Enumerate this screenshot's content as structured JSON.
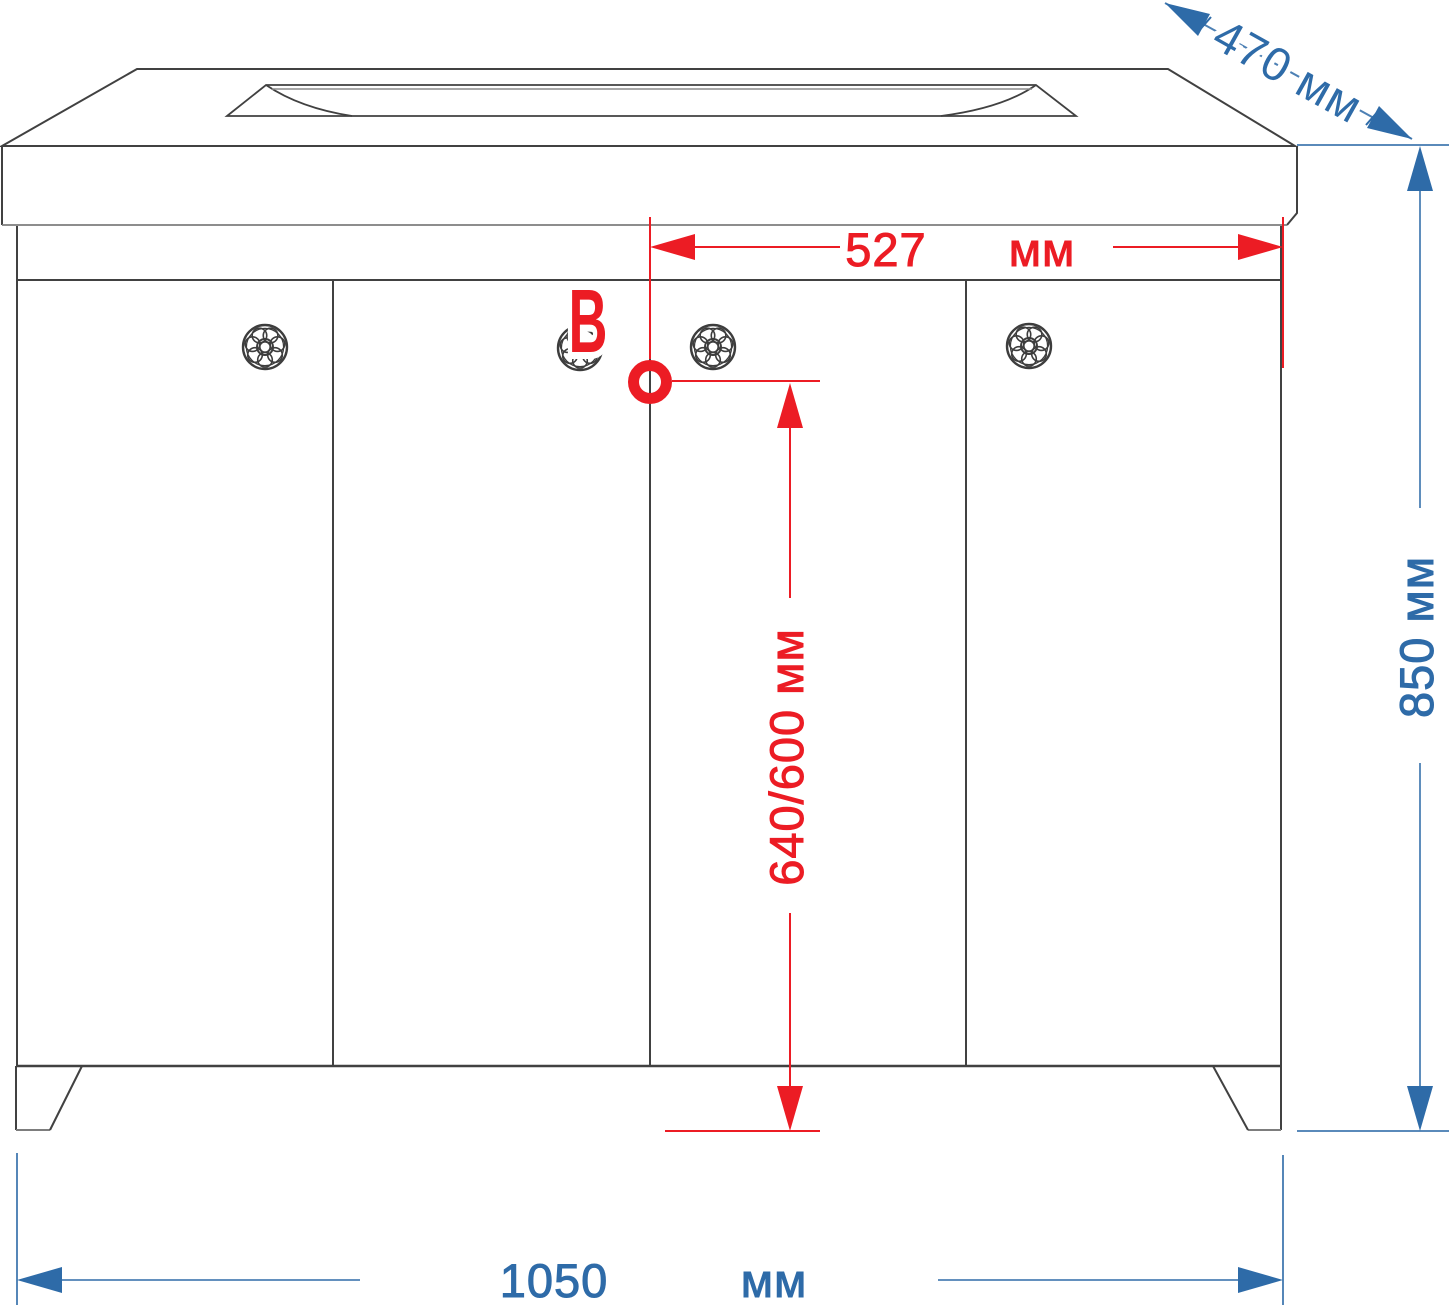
{
  "drawing": {
    "title": "Bathroom vanity cabinet dimension drawing",
    "colors": {
      "dimension_blue": "#2E6BA8",
      "dimension_red": "#EC1C24",
      "outline_dark": "#414141",
      "outline_light": "#8C8C8C"
    },
    "labels": {
      "depth": "470 мм",
      "offset_value": "527",
      "offset_unit": "мм",
      "height_rotated": "850 мм",
      "faucet_height_rotated": "640/600 мм",
      "width_value": "1050",
      "width_unit": "мм",
      "point": "В"
    },
    "dimensions_mm": {
      "overall_width": 1050,
      "overall_depth": 470,
      "overall_height": 850,
      "hole_offset_from_right": 527,
      "hole_height_from_floor": "640/600"
    },
    "structure": {
      "doors": 4,
      "knobs": 4,
      "legs": 2,
      "marked_point": "В"
    }
  }
}
